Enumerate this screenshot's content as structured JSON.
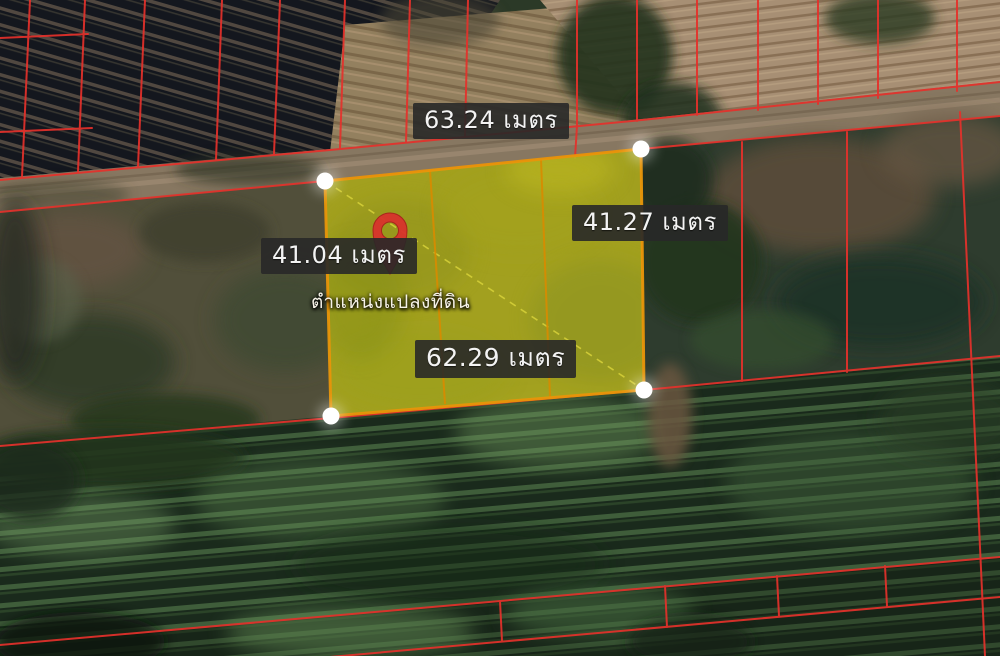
{
  "map": {
    "caption": "ตำแหน่งแปลงที่ดิน",
    "measurements": {
      "top": "63.24 เมตร",
      "right": "41.27 เมตร",
      "left": "41.04 เมตร",
      "bottom": "62.29 เมตร"
    },
    "colors": {
      "plot_fill": "#b4b01e",
      "plot_border": "#e8950a",
      "divider": "#d98b00",
      "parcel_line": "#e5312b",
      "pin": "#d8332c",
      "corner_marker": "#ffffff",
      "label_bg": "#282828",
      "label_text": "#f3f3f3"
    }
  }
}
